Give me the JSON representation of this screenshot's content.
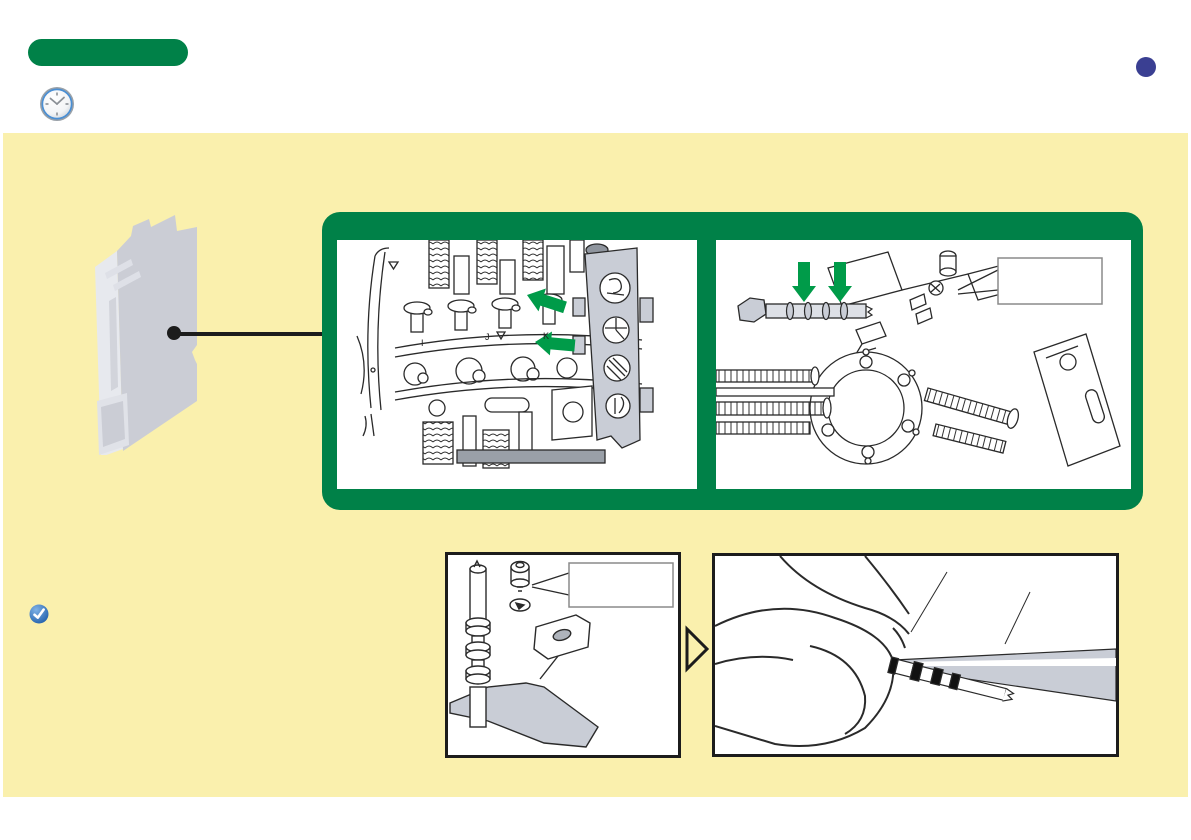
{
  "colors": {
    "panel_yellow": "#FAF0AD",
    "frame_green": "#008148",
    "arrow_green": "#009B49",
    "marker_blue": "#3A3F92",
    "check_blue": "#2B6CBF",
    "line_dark": "#1C1C1C",
    "metal_gray": "#C9CDD6"
  },
  "header": {
    "section_badge_text": "",
    "page_marker_text": ""
  },
  "figures": {
    "green_box": {
      "left_panel": {
        "drum_marks": [
          "I",
          "J",
          "K"
        ]
      },
      "right_panel": {
        "label_box_text": ""
      }
    },
    "steps": {
      "left_box": {
        "label_box_text": ""
      }
    }
  }
}
